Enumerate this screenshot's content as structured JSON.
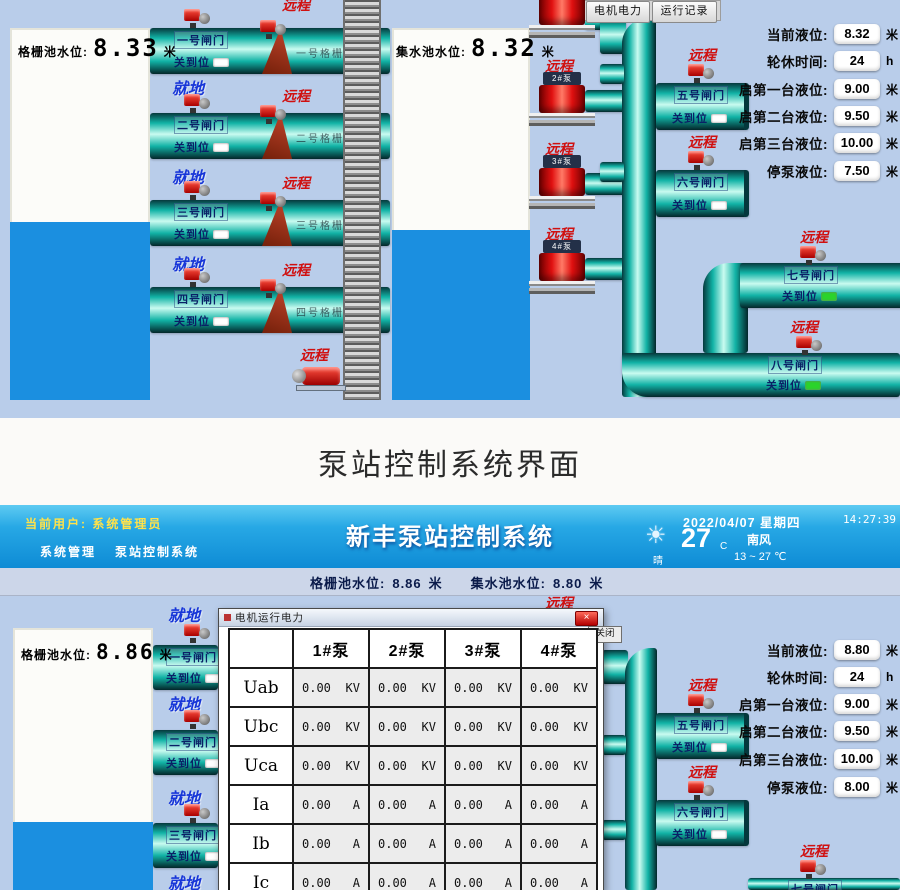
{
  "shared": {
    "remote": "远程",
    "local": "就地",
    "closed": "关到位"
  },
  "caption": "泵站控制系统界面",
  "colors": {
    "pipe": "#12b3a6",
    "water": "#1b8fe0",
    "remote_red": "#d01010",
    "local_blue": "#1736d8",
    "header_cyan": "#27a8e5",
    "indicator_green": "#2bd32b"
  },
  "top": {
    "toolbar": {
      "motor_power": "电机电力",
      "run_log": "运行记录"
    },
    "grid_tank": {
      "label": "格栅池水位:",
      "value": "8.33",
      "unit": "米"
    },
    "sump_tank": {
      "label": "集水池水位:",
      "value": "8.32",
      "unit": "米"
    },
    "gates_left": [
      {
        "name": "一号闸门"
      },
      {
        "name": "二号闸门"
      },
      {
        "name": "三号闸门"
      },
      {
        "name": "四号闸门"
      }
    ],
    "grid_machines": [
      {
        "name": "一号格栅机"
      },
      {
        "name": "二号格栅机"
      },
      {
        "name": "三号格栅机"
      },
      {
        "name": "四号格栅机"
      }
    ],
    "pumps": [
      {
        "name": "1#泵"
      },
      {
        "name": "2#泵"
      },
      {
        "name": "3#泵"
      },
      {
        "name": "4#泵"
      }
    ],
    "gates_right": [
      {
        "name": "五号闸门"
      },
      {
        "name": "六号闸门"
      },
      {
        "name": "七号闸门"
      },
      {
        "name": "八号闸门"
      }
    ],
    "panel": [
      {
        "label": "当前液位:",
        "value": "8.32",
        "unit": "米"
      },
      {
        "label": "轮休时间:",
        "value": "24",
        "unit": "h"
      },
      {
        "label": "启第一台液位:",
        "value": "9.00",
        "unit": "米"
      },
      {
        "label": "启第二台液位:",
        "value": "9.50",
        "unit": "米"
      },
      {
        "label": "启第三台液位:",
        "value": "10.00",
        "unit": "米"
      },
      {
        "label": "停泵液位:",
        "value": "7.50",
        "unit": "米"
      }
    ]
  },
  "bottom": {
    "user_label": "当前用户:",
    "user_name": "系统管理员",
    "menu": [
      "系统管理",
      "泵站控制系统"
    ],
    "title": "新丰泵站控制系统",
    "date": "2022/04/07",
    "weekday": "星期四",
    "time": "14:27:39",
    "weather": {
      "condition": "晴",
      "temp": "27",
      "temp_unit": "C",
      "wind": "南风",
      "range": "13 ~ 27 ℃"
    },
    "levels": {
      "grid_label": "格栅池水位:",
      "grid_value": "8.86",
      "sump_label": "集水池水位:",
      "sump_value": "8.80",
      "unit": "米"
    },
    "toolbar": {
      "video": "视频监控",
      "motor_power": "电机电力",
      "run_log": "运行记录"
    },
    "grid_tank": {
      "label": "格栅池水位:",
      "value": "8.86",
      "unit": "米"
    },
    "gates_left": [
      {
        "name": "一号闸门"
      },
      {
        "name": "二号闸门"
      },
      {
        "name": "三号闸门"
      }
    ],
    "gates_right": [
      {
        "name": "五号闸门"
      },
      {
        "name": "六号闸门"
      },
      {
        "name": "七号闸门"
      }
    ],
    "panel": [
      {
        "label": "当前液位:",
        "value": "8.80",
        "unit": "米"
      },
      {
        "label": "轮休时间:",
        "value": "24",
        "unit": "h"
      },
      {
        "label": "启第一台液位:",
        "value": "9.00",
        "unit": "米"
      },
      {
        "label": "启第二台液位:",
        "value": "9.50",
        "unit": "米"
      },
      {
        "label": "启第三台液位:",
        "value": "10.00",
        "unit": "米"
      },
      {
        "label": "停泵液位:",
        "value": "8.00",
        "unit": "米"
      }
    ],
    "dialog": {
      "title": "电机运行电力",
      "close_x": "×",
      "close_label": "关闭",
      "columns": [
        "1#泵",
        "2#泵",
        "3#泵",
        "4#泵"
      ],
      "rows": [
        {
          "param": "Uab",
          "unit": "KV",
          "values": [
            "0.00",
            "0.00",
            "0.00",
            "0.00"
          ]
        },
        {
          "param": "Ubc",
          "unit": "KV",
          "values": [
            "0.00",
            "0.00",
            "0.00",
            "0.00"
          ]
        },
        {
          "param": "Uca",
          "unit": "KV",
          "values": [
            "0.00",
            "0.00",
            "0.00",
            "0.00"
          ]
        },
        {
          "param": "Ia",
          "unit": "A",
          "values": [
            "0.00",
            "0.00",
            "0.00",
            "0.00"
          ]
        },
        {
          "param": "Ib",
          "unit": "A",
          "values": [
            "0.00",
            "0.00",
            "0.00",
            "0.00"
          ]
        },
        {
          "param": "Ic",
          "unit": "A",
          "values": [
            "0.00",
            "0.00",
            "0.00",
            "0.00"
          ]
        }
      ]
    }
  }
}
